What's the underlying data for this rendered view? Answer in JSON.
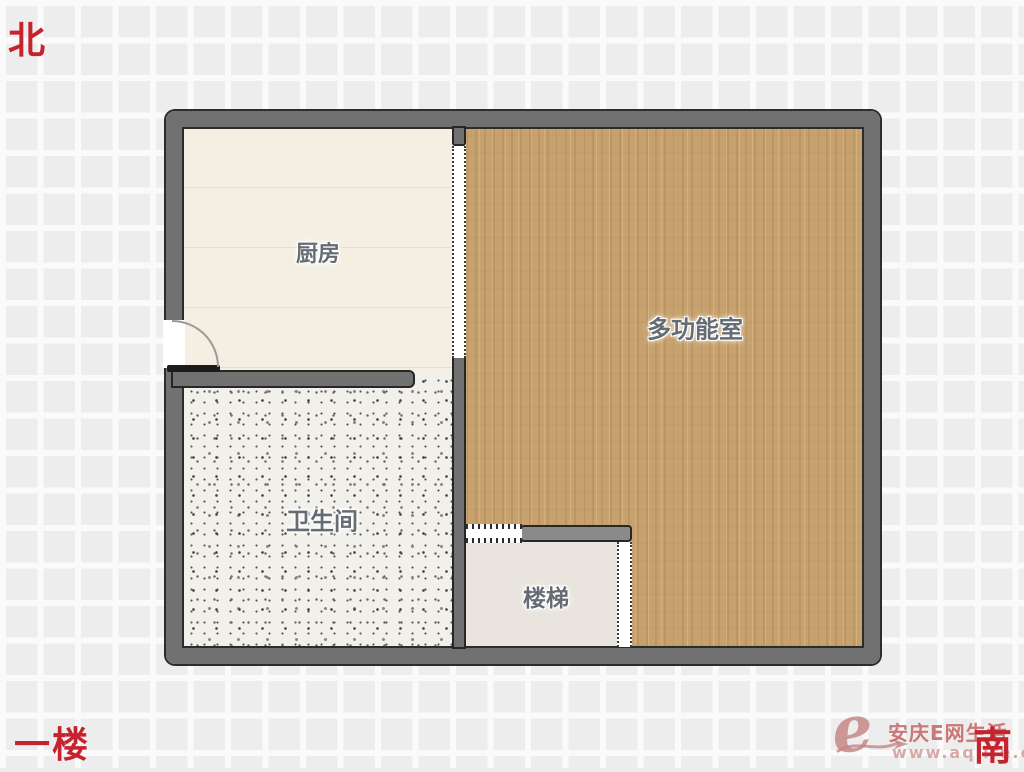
{
  "compass": {
    "north": "北",
    "south": "南"
  },
  "floor": {
    "label": "一楼"
  },
  "rooms": [
    {
      "name": "kitchen",
      "label": "厨房"
    },
    {
      "name": "multifunction-room",
      "label": "多功能室"
    },
    {
      "name": "bathroom",
      "label": "卫生间"
    },
    {
      "name": "stairs",
      "label": "楼梯"
    }
  ],
  "watermark": {
    "logo_letter": "e",
    "site_name": "安庆E网生活",
    "site_url": "www.aqlife.com"
  },
  "colors": {
    "wall": "#717171",
    "wood_floor": "#c7a26f",
    "kitchen_floor": "#f4efe2",
    "bathroom_floor": "#f2f0ea",
    "stairs_floor": "#e9e5de",
    "room_label_text": "#666c74",
    "compass_text": "#c5232d",
    "watermark_text": "#c68686"
  }
}
